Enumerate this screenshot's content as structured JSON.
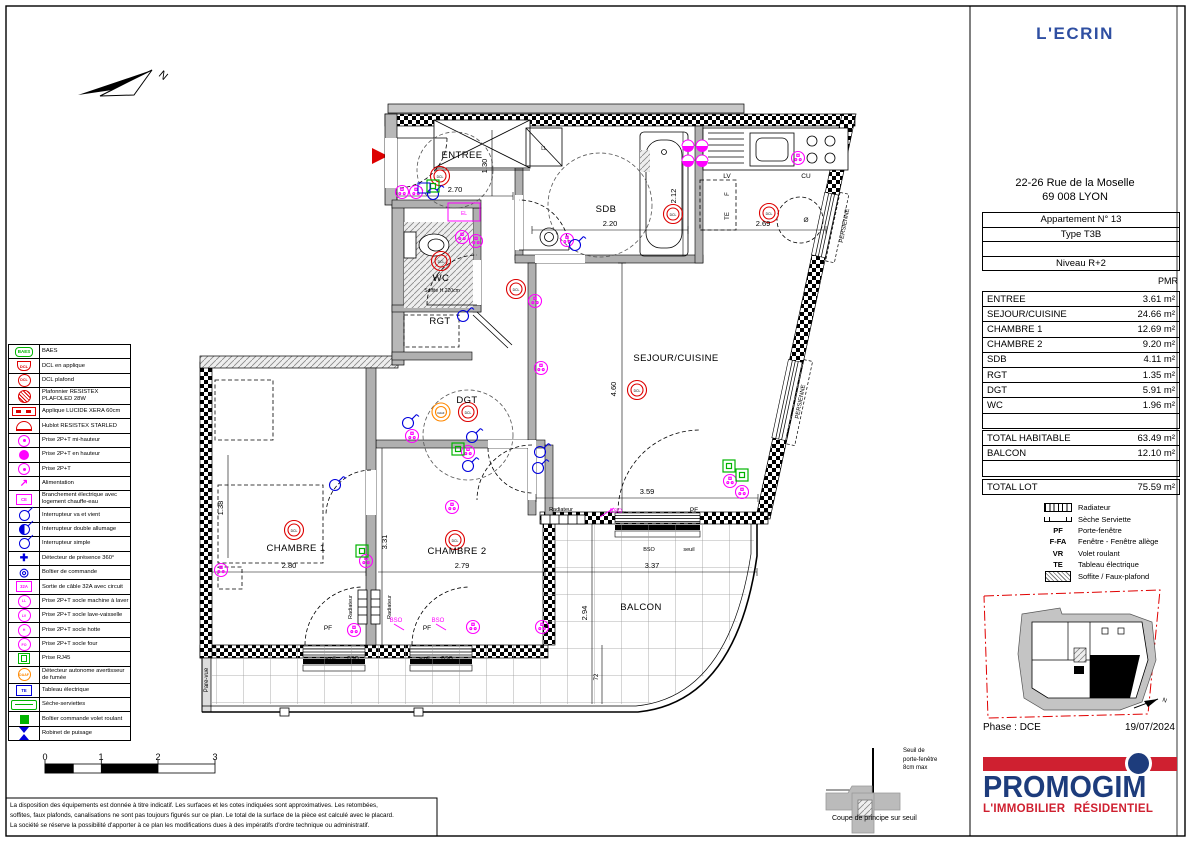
{
  "project_title": "L'ECRIN",
  "address": {
    "line1": "22-26 Rue de la Moselle",
    "line2": "69 008  LYON"
  },
  "apartment": {
    "rows": [
      "Appartement N° 13",
      "Type T3B",
      "",
      "Niveau R+2"
    ],
    "pmr": "PMR"
  },
  "areas": {
    "rows": [
      {
        "label": "ENTREE",
        "value": "3.61 m²"
      },
      {
        "label": "SEJOUR/CUISINE",
        "value": "24.66 m²"
      },
      {
        "label": "CHAMBRE 1",
        "value": "12.69 m²"
      },
      {
        "label": "CHAMBRE 2",
        "value": "9.20 m²"
      },
      {
        "label": "SDB",
        "value": "4.11 m²"
      },
      {
        "label": "RGT",
        "value": "1.35 m²"
      },
      {
        "label": "DGT",
        "value": "5.91 m²"
      },
      {
        "label": "WC",
        "value": "1.96 m²"
      },
      {
        "label": "",
        "value": ""
      }
    ]
  },
  "totals": {
    "rows": [
      {
        "label": "TOTAL HABITABLE",
        "value": "63.49 m²"
      },
      {
        "label": "BALCON",
        "value": "12.10 m²"
      },
      {
        "label": "",
        "value": ""
      }
    ]
  },
  "lot": {
    "label": "TOTAL LOT",
    "value": "75.59 m²"
  },
  "mini_legend": {
    "items": [
      {
        "icon": "mi-rad",
        "abbr": "",
        "label": "Radiateur"
      },
      {
        "icon": "mi-sec",
        "abbr": "",
        "label": "Sèche Serviette"
      },
      {
        "icon": "",
        "abbr": "PF",
        "label": "Porte-fenêtre"
      },
      {
        "icon": "",
        "abbr": "F-FA",
        "label": "Fenêtre - Fenêtre allège"
      },
      {
        "icon": "",
        "abbr": "VR",
        "label": "Volet roulant"
      },
      {
        "icon": "",
        "abbr": "TE",
        "label": "Tableau électrique"
      },
      {
        "icon": "mi-hat",
        "abbr": "",
        "label": "Soffite / Faux-plafond"
      }
    ]
  },
  "phase": "Phase : DCE",
  "date": "19/07/2024",
  "logo": {
    "brand": "PROMOGIM",
    "tagline": "L'IMMOBILIER RÉSIDENTIEL"
  },
  "legend": {
    "items": [
      {
        "cls": "c-green s-pill",
        "glyph": "BAES",
        "label": "BAES"
      },
      {
        "cls": "c-red s-shield",
        "glyph": "DCL",
        "label": "DCL en applique"
      },
      {
        "cls": "c-red s-circle",
        "glyph": "DCL",
        "label": "DCL plafond"
      },
      {
        "cls": "c-red s-chatch",
        "glyph": "",
        "label": "Plafonnier RESISTEX PLAFOLED 28W"
      },
      {
        "cls": "c-red s-bar",
        "glyph": "",
        "label": "Applique LUCIDE XERA 60cm"
      },
      {
        "cls": "c-red s-half",
        "glyph": "",
        "label": "Hublot RESISTEX STARLED"
      },
      {
        "cls": "c-mag s-cdot",
        "glyph": "",
        "label": "Prise 2P+T mi-hauteur"
      },
      {
        "cls": "c-mag s-cfill",
        "glyph": "",
        "label": "Prise 2P+T en hauteur"
      },
      {
        "cls": "c-mag s-cdot",
        "glyph": "",
        "label": "Prise 2P+T"
      },
      {
        "cls": "c-mag s-arrow",
        "glyph": "↗",
        "label": "Alimentation"
      },
      {
        "cls": "c-mag s-box",
        "glyph": "CE",
        "label": "Branchement électrique avec logement chauffe-eau"
      },
      {
        "cls": "c-blue s-switch",
        "glyph": "",
        "label": "Interrupteur va et vient"
      },
      {
        "cls": "c-blue s-switch s-sw2",
        "glyph": "",
        "label": "Interrupteur double allumage"
      },
      {
        "cls": "c-blue s-switch",
        "glyph": "",
        "label": "Interrupteur simple"
      },
      {
        "cls": "c-blue s-cross",
        "glyph": "✚",
        "label": "Détecteur de présence 360°"
      },
      {
        "cls": "c-blue s-rings",
        "glyph": "◎",
        "label": "Boîtier de commande"
      },
      {
        "cls": "c-mag s-box",
        "glyph": "32A",
        "label": "Sortie de câble 32A avec circuit"
      },
      {
        "cls": "c-mag s-circle",
        "glyph": "LL",
        "label": "Prise 2P+T socle machine à laver"
      },
      {
        "cls": "c-mag s-circle",
        "glyph": "LV",
        "label": "Prise 2P+T socle lave-vaisselle"
      },
      {
        "cls": "c-mag s-circle",
        "glyph": "H",
        "label": "Prise 2P+T socle hotte"
      },
      {
        "cls": "c-mag s-circle",
        "glyph": "FO",
        "label": "Prise 2P+T socle four"
      },
      {
        "cls": "c-green s-rj",
        "glyph": "",
        "label": "Prise RJ45"
      },
      {
        "cls": "c-orange s-circle",
        "glyph": "DAAF",
        "label": "Détecteur autonome avertisseur de fumée"
      },
      {
        "cls": "c-blue s-box",
        "glyph": "TE",
        "label": "Tableau électrique"
      },
      {
        "cls": "c-green s-wide",
        "glyph": "",
        "label": "Sèche-serviettes"
      },
      {
        "cls": "c-green s-bfill",
        "glyph": "",
        "label": "Boîtier commande volet roulant"
      },
      {
        "cls": "c-blue s-hour",
        "glyph": "",
        "label": "Robinet de puisage"
      }
    ]
  },
  "plan": {
    "rooms": [
      {
        "t": "ENTREE",
        "x": 462,
        "y": 158
      },
      {
        "t": "SDB",
        "x": 606,
        "y": 212
      },
      {
        "t": "WC",
        "x": 441,
        "y": 281
      },
      {
        "t": "RGT",
        "x": 440,
        "y": 324
      },
      {
        "t": "DGT",
        "x": 467,
        "y": 403
      },
      {
        "t": "SEJOUR/CUISINE",
        "x": 676,
        "y": 361
      },
      {
        "t": "CHAMBRE 1",
        "x": 296,
        "y": 551
      },
      {
        "t": "CHAMBRE 2",
        "x": 457,
        "y": 554
      },
      {
        "t": "BALCON",
        "x": 641,
        "y": 610
      }
    ],
    "dims": [
      {
        "t": "2.70",
        "x": 455,
        "y": 192
      },
      {
        "t": "1.30",
        "x": 487,
        "y": 166,
        "r": -90
      },
      {
        "t": "2.20",
        "x": 610,
        "y": 226
      },
      {
        "t": "2.12",
        "x": 676,
        "y": 196,
        "r": -90
      },
      {
        "t": "2.69",
        "x": 763,
        "y": 226
      },
      {
        "t": "4.60",
        "x": 616,
        "y": 389,
        "r": -90
      },
      {
        "t": "3.59",
        "x": 647,
        "y": 494
      },
      {
        "t": "2.80",
        "x": 289,
        "y": 568
      },
      {
        "t": "2.79",
        "x": 462,
        "y": 568
      },
      {
        "t": "3.37",
        "x": 652,
        "y": 568
      },
      {
        "t": "3.31",
        "x": 387,
        "y": 542,
        "r": -90
      },
      {
        "t": "1.38",
        "x": 223,
        "y": 508,
        "r": -90
      },
      {
        "t": "2.94",
        "x": 587,
        "y": 613,
        "r": -90
      },
      {
        "t": "72",
        "x": 598,
        "y": 677,
        "r": -90,
        "s": 6
      }
    ],
    "sb": [
      {
        "t": "0",
        "x": 45,
        "y": 760,
        "s": 9
      },
      {
        "t": "1",
        "x": 101,
        "y": 760,
        "s": 9
      },
      {
        "t": "2",
        "x": 158,
        "y": 760,
        "s": 9
      },
      {
        "t": "3",
        "x": 215,
        "y": 760,
        "s": 9
      }
    ],
    "notes": [
      {
        "t": "PF",
        "x": 694,
        "y": 512
      },
      {
        "t": "PF",
        "x": 328,
        "y": 630
      },
      {
        "t": "PF",
        "x": 427,
        "y": 630
      },
      {
        "t": "seuil",
        "x": 330,
        "y": 660,
        "s": 5.5
      },
      {
        "t": "BSO",
        "x": 353,
        "y": 660,
        "s": 5.5
      },
      {
        "t": "seuil",
        "x": 424,
        "y": 660,
        "s": 5.5
      },
      {
        "t": "BSO",
        "x": 447,
        "y": 660,
        "s": 5.5
      },
      {
        "t": "BSO",
        "x": 649,
        "y": 551,
        "s": 5.5
      },
      {
        "t": "seuil",
        "x": 689,
        "y": 551,
        "s": 5.5
      },
      {
        "t": "Radiateur",
        "x": 561,
        "y": 511,
        "s": 5.5
      },
      {
        "t": "Radiateur",
        "x": 352,
        "y": 607,
        "r": -90,
        "s": 5.5
      },
      {
        "t": "Radiateur",
        "x": 391,
        "y": 607,
        "r": -90,
        "s": 5.5
      },
      {
        "t": "Pare-vue",
        "x": 208,
        "y": 680,
        "r": -90,
        "s": 6
      },
      {
        "t": "PERSIENNE",
        "x": 846,
        "y": 226,
        "r": -79,
        "s": 6
      },
      {
        "t": "PERSIENNE",
        "x": 802,
        "y": 402,
        "r": -79,
        "s": 6
      },
      {
        "t": "LV",
        "x": 727,
        "y": 178
      },
      {
        "t": "CU",
        "x": 806,
        "y": 178
      },
      {
        "t": "F",
        "x": 729,
        "y": 194,
        "r": -90,
        "s": 6
      },
      {
        "t": "TE",
        "x": 729,
        "y": 216,
        "r": -90,
        "s": 6
      },
      {
        "t": "Ø",
        "x": 806,
        "y": 222
      },
      {
        "t": "LL",
        "x": 544,
        "y": 150,
        "s": 5
      },
      {
        "t": "Soffite H.220cm",
        "x": 442,
        "y": 292,
        "s": 5
      },
      {
        "t": "BSO",
        "x": 616,
        "y": 513,
        "m": 1,
        "s": 6
      },
      {
        "t": "BSO",
        "x": 396,
        "y": 622,
        "m": 1,
        "s": 6
      },
      {
        "t": "BSO",
        "x": 438,
        "y": 622,
        "m": 1,
        "s": 6
      },
      {
        "t": "EL",
        "x": 464,
        "y": 215,
        "m": 1,
        "s": 5
      },
      {
        "t": "N",
        "x": 161,
        "y": 78,
        "r": 40,
        "s": 11
      },
      {
        "t": "N",
        "x": 1164,
        "y": 702,
        "s": 6,
        "r": 20
      },
      {
        "t": "DCL",
        "x": 440,
        "y": 178,
        "c": "#dd0000",
        "s": 3.4
      },
      {
        "t": "DCL",
        "x": 441,
        "y": 263,
        "c": "#dd0000",
        "s": 3.4
      },
      {
        "t": "DCL",
        "x": 516,
        "y": 291,
        "c": "#dd0000",
        "s": 3.4
      },
      {
        "t": "DCL",
        "x": 673,
        "y": 216,
        "c": "#dd0000",
        "s": 3.4
      },
      {
        "t": "DCL",
        "x": 769,
        "y": 215,
        "c": "#dd0000",
        "s": 3.4
      },
      {
        "t": "DCL",
        "x": 468,
        "y": 414,
        "c": "#dd0000",
        "s": 3.4
      },
      {
        "t": "DCL",
        "x": 637,
        "y": 392,
        "c": "#dd0000",
        "s": 3.4
      },
      {
        "t": "DCL",
        "x": 294,
        "y": 532,
        "c": "#dd0000",
        "s": 3.4
      },
      {
        "t": "DCL",
        "x": 455,
        "y": 542,
        "c": "#dd0000",
        "s": 3.4
      },
      {
        "t": "DAAF",
        "x": 441,
        "y": 414,
        "c": "#ff8800",
        "s": 2.6
      }
    ]
  },
  "coupe": {
    "note1": "Seuil de",
    "note2": "porte-fenêtre",
    "note3": "8cm max",
    "caption": "Coupe de principe sur seuil"
  },
  "disclaimer": [
    "La disposition des équipements est donnée à titre indicatif.  Les surfaces et les cotes indiquées sont approximatives.  Les retombées,",
    "soffites, faux plafonds, canalisations ne sont pas toujours figurés sur ce plan.  Le total de la surface de la pièce est calculé avec le placard.",
    "La société se réserve la possibilité d'apporter à ce plan les modifications dues à des impératifs d'ordre technique ou administratif."
  ],
  "colors": {
    "accent_blue": "#2f4fa2",
    "logo_blue": "#1d3c7c",
    "logo_red": "#cf2030",
    "symbol_red": "#dd0000",
    "symbol_magenta": "#ff00ff",
    "symbol_blue": "#0000dd",
    "symbol_green": "#00b400",
    "symbol_orange": "#ff8800"
  }
}
